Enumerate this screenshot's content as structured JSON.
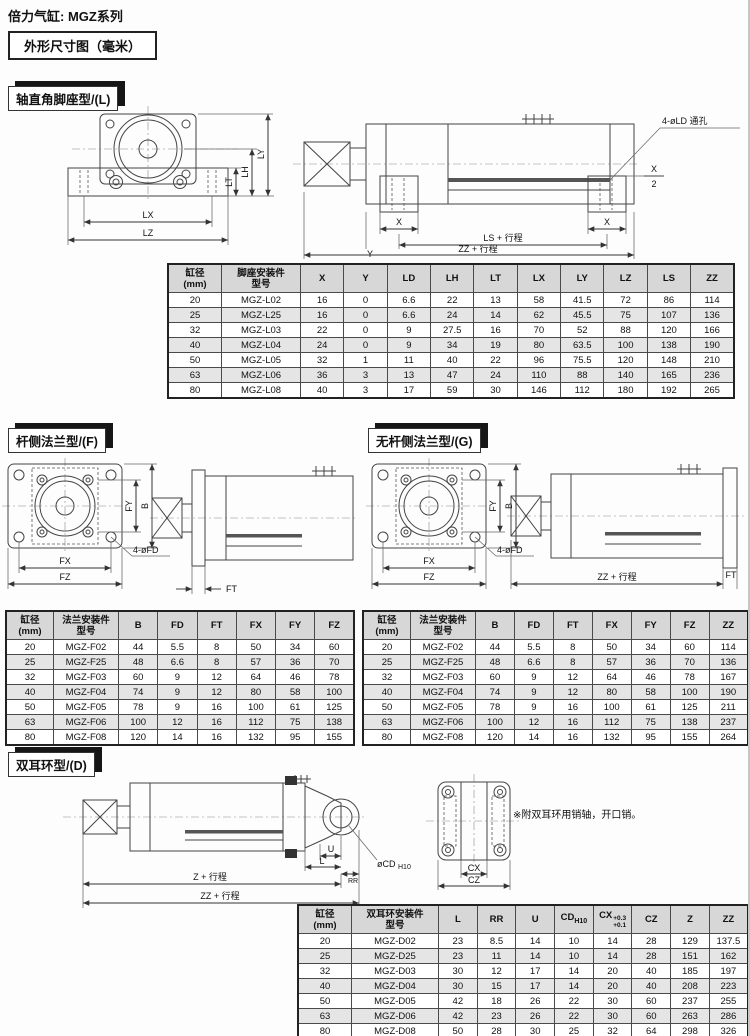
{
  "page": {
    "title": "倍力气缸: MGZ系列",
    "dim_box": "外形尺寸图（毫米）"
  },
  "sections": {
    "l": {
      "header": "轴直角脚座型/(L)"
    },
    "f": {
      "header": "杆侧法兰型/(F)"
    },
    "g": {
      "header": "无杆侧法兰型/(G)"
    },
    "d": {
      "header": "双耳环型/(D)",
      "note": "※附双耳环用销轴，开口销。"
    }
  },
  "drawings": {
    "l_front": {
      "ly": "LY",
      "lh": "LH",
      "lt": "LT",
      "lx": "LX",
      "lz": "LZ"
    },
    "l_side": {
      "callout": "4-øLD 通孔",
      "x_left": "X",
      "y": "Y",
      "x_right": "X",
      "x_frac_top": "X",
      "x_frac_bottom": "2",
      "ls": "LS + 行程",
      "zz": "ZZ + 行程"
    },
    "f_front": {
      "fy": "FY",
      "b": "B",
      "fx": "FX",
      "fz": "FZ",
      "callout": "4-øFD"
    },
    "f_side": {
      "ft": "FT"
    },
    "g_front": {
      "fy": "FY",
      "b": "B",
      "fx": "FX",
      "fz": "FZ",
      "callout": "4-øFD"
    },
    "g_side": {
      "zz": "ZZ + 行程",
      "ft": "FT"
    },
    "d_side": {
      "u": "U",
      "l": "L",
      "rr": "RR",
      "cd_main": "øCD",
      "cd_sub": "H10",
      "z": "Z + 行程",
      "zz": "ZZ + 行程"
    },
    "d_rear": {
      "cx": "CX",
      "cz": "CZ"
    }
  },
  "tables": {
    "l": {
      "columns": [
        "缸径\n(mm)",
        "脚座安装件\n型号",
        "X",
        "Y",
        "LD",
        "LH",
        "LT",
        "LX",
        "LY",
        "LZ",
        "LS",
        "ZZ"
      ],
      "rows": [
        [
          "20",
          "MGZ-L02",
          "16",
          "0",
          "6.6",
          "22",
          "13",
          "58",
          "41.5",
          "72",
          "86",
          "114"
        ],
        [
          "25",
          "MGZ-L25",
          "16",
          "0",
          "6.6",
          "24",
          "14",
          "62",
          "45.5",
          "75",
          "107",
          "136"
        ],
        [
          "32",
          "MGZ-L03",
          "22",
          "0",
          "9",
          "27.5",
          "16",
          "70",
          "52",
          "88",
          "120",
          "166"
        ],
        [
          "40",
          "MGZ-L04",
          "24",
          "0",
          "9",
          "34",
          "19",
          "80",
          "63.5",
          "100",
          "138",
          "190"
        ],
        [
          "50",
          "MGZ-L05",
          "32",
          "1",
          "11",
          "40",
          "22",
          "96",
          "75.5",
          "120",
          "148",
          "210"
        ],
        [
          "63",
          "MGZ-L06",
          "36",
          "3",
          "13",
          "47",
          "24",
          "110",
          "88",
          "140",
          "165",
          "236"
        ],
        [
          "80",
          "MGZ-L08",
          "40",
          "3",
          "17",
          "59",
          "30",
          "146",
          "112",
          "180",
          "192",
          "265"
        ]
      ]
    },
    "f": {
      "columns": [
        "缸径\n(mm)",
        "法兰安装件\n型号",
        "B",
        "FD",
        "FT",
        "FX",
        "FY",
        "FZ"
      ],
      "rows": [
        [
          "20",
          "MGZ-F02",
          "44",
          "5.5",
          "8",
          "50",
          "34",
          "60"
        ],
        [
          "25",
          "MGZ-F25",
          "48",
          "6.6",
          "8",
          "57",
          "36",
          "70"
        ],
        [
          "32",
          "MGZ-F03",
          "60",
          "9",
          "12",
          "64",
          "46",
          "78"
        ],
        [
          "40",
          "MGZ-F04",
          "74",
          "9",
          "12",
          "80",
          "58",
          "100"
        ],
        [
          "50",
          "MGZ-F05",
          "78",
          "9",
          "16",
          "100",
          "61",
          "125"
        ],
        [
          "63",
          "MGZ-F06",
          "100",
          "12",
          "16",
          "112",
          "75",
          "138"
        ],
        [
          "80",
          "MGZ-F08",
          "120",
          "14",
          "16",
          "132",
          "95",
          "155"
        ]
      ]
    },
    "g": {
      "columns": [
        "缸径\n(mm)",
        "法兰安装件\n型号",
        "B",
        "FD",
        "FT",
        "FX",
        "FY",
        "FZ",
        "ZZ"
      ],
      "rows": [
        [
          "20",
          "MGZ-F02",
          "44",
          "5.5",
          "8",
          "50",
          "34",
          "60",
          "114"
        ],
        [
          "25",
          "MGZ-F25",
          "48",
          "6.6",
          "8",
          "57",
          "36",
          "70",
          "136"
        ],
        [
          "32",
          "MGZ-F03",
          "60",
          "9",
          "12",
          "64",
          "46",
          "78",
          "167"
        ],
        [
          "40",
          "MGZ-F04",
          "74",
          "9",
          "12",
          "80",
          "58",
          "100",
          "190"
        ],
        [
          "50",
          "MGZ-F05",
          "78",
          "9",
          "16",
          "100",
          "61",
          "125",
          "211"
        ],
        [
          "63",
          "MGZ-F06",
          "100",
          "12",
          "16",
          "112",
          "75",
          "138",
          "237"
        ],
        [
          "80",
          "MGZ-F08",
          "120",
          "14",
          "16",
          "132",
          "95",
          "155",
          "264"
        ]
      ]
    },
    "d": {
      "columns": [
        "缸径\n(mm)",
        "双耳环安装件\n型号",
        "L",
        "RR",
        "U",
        {
          "main": "CD",
          "sub": "H10"
        },
        {
          "main": "CX",
          "sup": "+0.3",
          "sub": "+0.1"
        },
        "CZ",
        "Z",
        "ZZ"
      ],
      "rows": [
        [
          "20",
          "MGZ-D02",
          "23",
          "8.5",
          "14",
          "10",
          "14",
          "28",
          "129",
          "137.5"
        ],
        [
          "25",
          "MGZ-D25",
          "23",
          "11",
          "14",
          "10",
          "14",
          "28",
          "151",
          "162"
        ],
        [
          "32",
          "MGZ-D03",
          "30",
          "12",
          "17",
          "14",
          "20",
          "40",
          "185",
          "197"
        ],
        [
          "40",
          "MGZ-D04",
          "30",
          "15",
          "17",
          "14",
          "20",
          "40",
          "208",
          "223"
        ],
        [
          "50",
          "MGZ-D05",
          "42",
          "18",
          "26",
          "22",
          "30",
          "60",
          "237",
          "255"
        ],
        [
          "63",
          "MGZ-D06",
          "42",
          "23",
          "26",
          "22",
          "30",
          "60",
          "263",
          "286"
        ],
        [
          "80",
          "MGZ-D08",
          "50",
          "28",
          "30",
          "25",
          "32",
          "64",
          "298",
          "326"
        ]
      ]
    }
  }
}
